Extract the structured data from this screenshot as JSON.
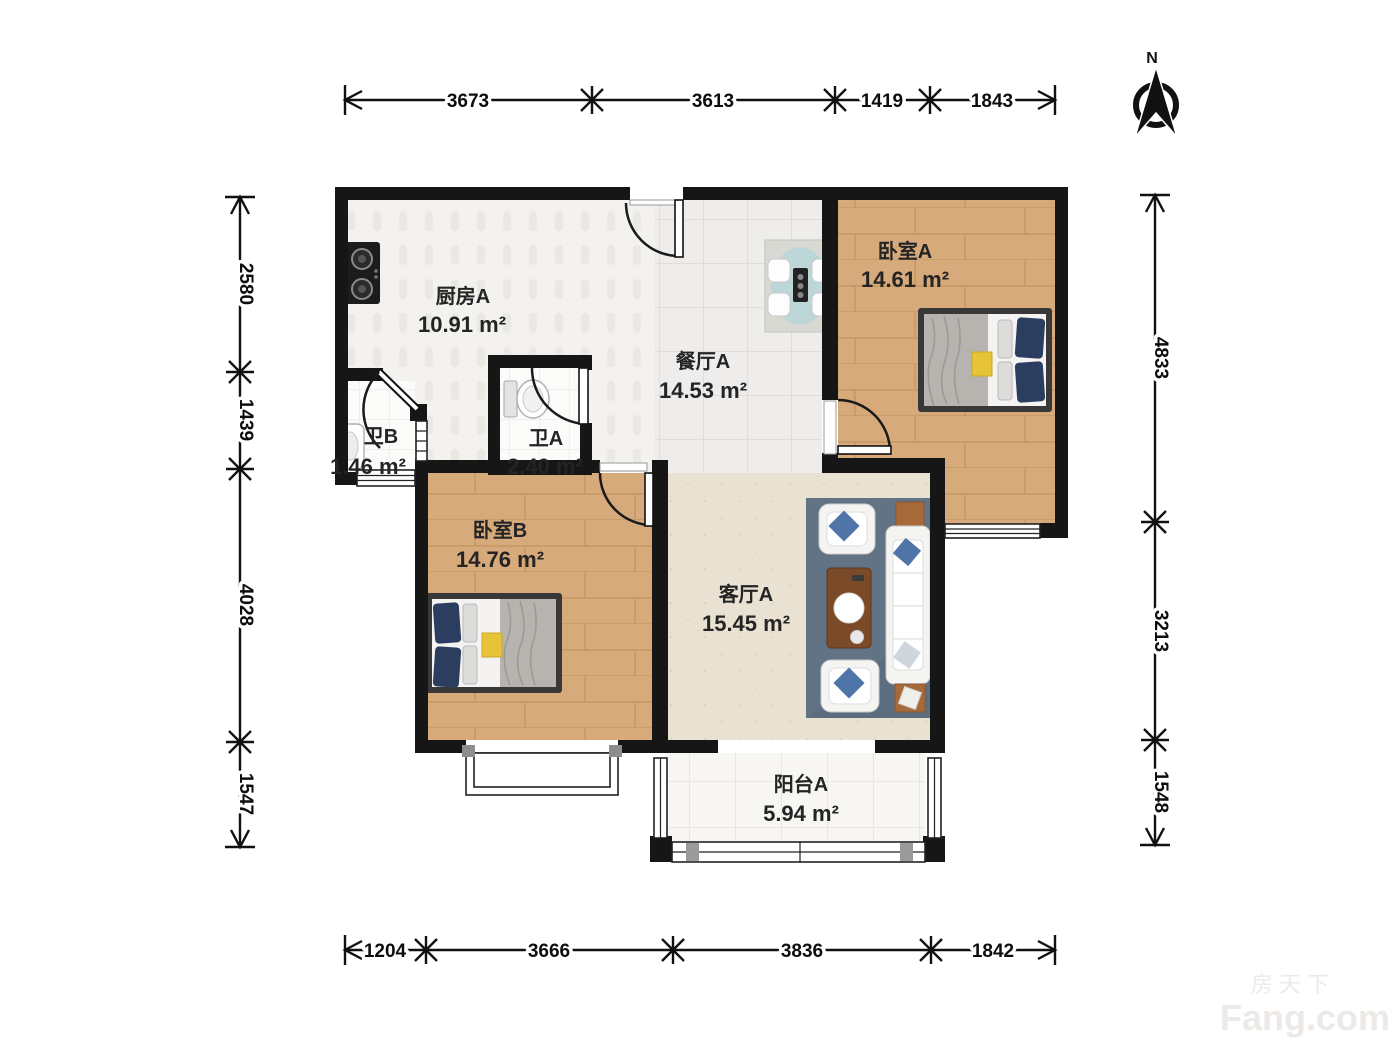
{
  "plan_title": "two-bedroom apartment floor plan",
  "north_label": "N",
  "rooms": {
    "kitchen": {
      "name": "厨房A",
      "area": "10.91 m²"
    },
    "dining": {
      "name": "餐厅A",
      "area": "14.53 m²"
    },
    "bedroom_a": {
      "name": "卧室A",
      "area": "14.61 m²"
    },
    "bedroom_b": {
      "name": "卧室B",
      "area": "14.76 m²"
    },
    "living": {
      "name": "客厅A",
      "area": "15.45 m²"
    },
    "bath_a": {
      "name": "卫A",
      "area": "2.40 m²"
    },
    "bath_b": {
      "name": "卫B",
      "area": "1.46 m²"
    },
    "balcony": {
      "name": "阳台A",
      "area": "5.94 m²"
    }
  },
  "dimensions": {
    "top": [
      "3673",
      "3613",
      "1419",
      "1843"
    ],
    "bottom": [
      "1204",
      "3666",
      "3836",
      "1842"
    ],
    "left": [
      "2580",
      "1439",
      "4028",
      "1547"
    ],
    "right": [
      "4833",
      "3213",
      "1548"
    ]
  },
  "watermark": {
    "cn": "房天下",
    "en": "Fang.com"
  },
  "colors": {
    "wall": "#161616",
    "wood_floor": "#d7aa7c",
    "carpet": "#e9e2d3",
    "rug": "#5d6d80",
    "pillow_blue": "#3e5a82",
    "table_brown": "#7b4a28",
    "accent_yellow": "#e7c437"
  }
}
